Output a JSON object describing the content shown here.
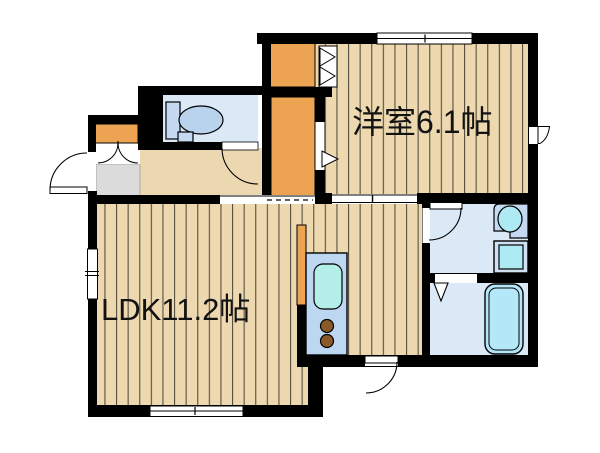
{
  "floor_plan": {
    "type": "japanese-apartment-floorplan",
    "rooms": [
      {
        "id": "western-room",
        "label": "洋室6.1帖",
        "size_tatami": "6.1"
      },
      {
        "id": "ldk",
        "label": "LDK11.2帖",
        "size_tatami": "11.2"
      },
      {
        "id": "toilet-room",
        "label": ""
      },
      {
        "id": "washroom",
        "label": ""
      },
      {
        "id": "bathroom",
        "label": ""
      },
      {
        "id": "hallway",
        "label": ""
      },
      {
        "id": "entrance-genkan",
        "label": ""
      },
      {
        "id": "closet-upper",
        "label": ""
      },
      {
        "id": "closet-lower",
        "label": ""
      },
      {
        "id": "shoe-cabinet",
        "label": ""
      }
    ],
    "fixtures": [
      "toilet",
      "wash-basin",
      "washing-machine-pan",
      "bathtub",
      "kitchen-counter",
      "kitchen-sink",
      "stove-burners"
    ],
    "colors": {
      "wall": "#000000",
      "wood_floor": "#edd8af",
      "wood_stripe": "#55503f",
      "hallway_floor": "#ecd8b0",
      "closet_orange": "#eca453",
      "genkan_gray": "#dbdbdb",
      "wet_room_blue": "#dbe8f6",
      "counter_blue": "#bdd7f2",
      "water_cyan": "#b4e9f0",
      "toilet_tank_blue": "#c6d9f2",
      "toilet_bowl_blue": "#b9d3ee",
      "burner_brown": "#8a5a28",
      "background": "#ffffff"
    }
  }
}
